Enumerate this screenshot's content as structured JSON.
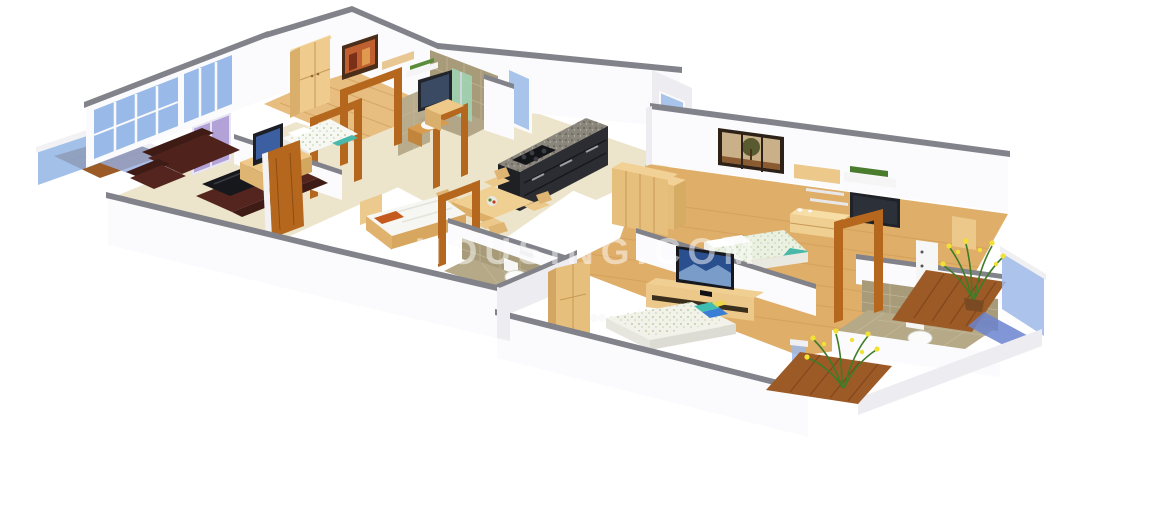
{
  "watermark": {
    "text": "HOUSING.COM",
    "color": "#ffffff",
    "opacity": 0.5
  },
  "palette": {
    "background": "#ffffff",
    "wall": "#fbfbfd",
    "wall_shaded": "#ececf1",
    "wall_cap": "#82828a",
    "floor_cream": "#ece4cb",
    "wood_floor_light": "#e7bd80",
    "wood_floor_warm": "#dfae69",
    "deck_wood": "#9c5a26",
    "furniture_wood": "#efcb8e",
    "door_wood": "#b5671e",
    "sofa_leather": "#4f221c",
    "coffee_table": "#17181c",
    "glass_blue": "#93b6e8",
    "glass_green": "#9fd6b5",
    "glass_lavender": "#b3a2d8",
    "tile_tan": "#a89b79",
    "kitchen_cabinet": "#2c2d33",
    "granite": "#8a867c",
    "tv_dark": "#1d1f26",
    "tv_screen": "#3b5fa0",
    "bedding_white": "#f6f6f2",
    "bedding_green": "#e6eddb",
    "pillow_teal": "#3fbdb0",
    "pillow_blue": "#3a7fd5",
    "pillow_yellow": "#e8d44d",
    "pillow_orange": "#c55a1e",
    "plant_green": "#3e7c28",
    "flower_yellow": "#f2e135"
  },
  "scene": {
    "type": "3d-isometric-floor-plan-render",
    "rooms": [
      {
        "name": "balcony-left",
        "items": [
          "glass-railing",
          "wood-deck"
        ]
      },
      {
        "name": "living-room",
        "items": [
          "leather-sofa-set",
          "coffee-table",
          "tv-sideboard",
          "television",
          "wooden-door",
          "window-wall",
          "lavender-glass-door"
        ]
      },
      {
        "name": "bedroom-1",
        "items": [
          "double-bed",
          "wardrobe",
          "wall-art",
          "wall-shelves",
          "wall-tv",
          "study-desk",
          "open-door-frames"
        ]
      },
      {
        "name": "bathroom-1",
        "items": [
          "glass-shower",
          "wash-basin",
          "tiled-walls",
          "door-frame"
        ]
      },
      {
        "name": "kitchen",
        "items": [
          "black-modular-counter",
          "granite-top",
          "gas-stove",
          "window",
          "side-cabinets"
        ]
      },
      {
        "name": "dining-area",
        "items": [
          "dining-table",
          "four-chairs",
          "fruit-platter"
        ]
      },
      {
        "name": "bedroom-2",
        "items": [
          "single-bed",
          "orange-pillow",
          "door-frame"
        ]
      },
      {
        "name": "bathroom-2",
        "items": [
          "toilet",
          "flush-plate",
          "tiled-walls"
        ]
      },
      {
        "name": "master-bedroom",
        "items": [
          "double-bed",
          "teal-throw",
          "wardrobe-row",
          "dresser",
          "floating-shelves",
          "shelf-plant",
          "wall-tv",
          "tree-wall-art"
        ]
      },
      {
        "name": "bedroom-3",
        "items": [
          "double-bed",
          "colorful-pillows",
          "tv-unit",
          "television",
          "wardrobe",
          "door-frame"
        ]
      },
      {
        "name": "bathroom-3",
        "items": [
          "toilet",
          "flush-plate",
          "storage-cabinet",
          "tiled-walls"
        ]
      },
      {
        "name": "balcony-right",
        "items": [
          "flowering-plant",
          "glass-railing",
          "wood-deck"
        ]
      },
      {
        "name": "balcony-front",
        "items": [
          "flowering-plant",
          "glass-railing",
          "wood-deck"
        ]
      }
    ]
  }
}
